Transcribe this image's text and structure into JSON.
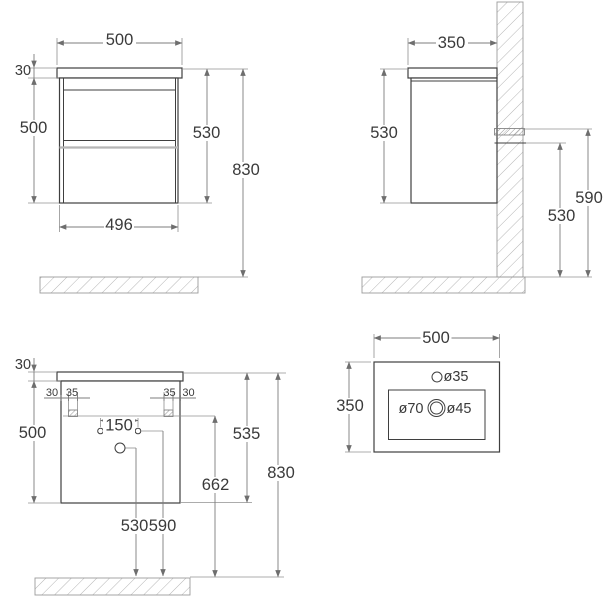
{
  "page": {
    "background": "#ffffff"
  },
  "colors": {
    "line": "#3f3f3f",
    "dimension": "#7d7d7d",
    "hatch": "#b5b5b5",
    "text": "#3a3a3a"
  },
  "views": {
    "front": {
      "width_top": "500",
      "top_thickness": "30",
      "body_height": "500",
      "cabinet_height": "530",
      "overall_height": "830",
      "width_bottom": "496"
    },
    "side": {
      "depth": "350",
      "cabinet_height": "530",
      "hanger_top_height": "590",
      "hanger_bottom_height": "530"
    },
    "back": {
      "top_thickness": "30",
      "body_height": "500",
      "hanger_offset_left": "30",
      "hanger_width_left": "35",
      "hanger_width_right": "35",
      "hanger_offset_right": "30",
      "supply_hole_spacing": "150",
      "drain_hole_height": "530",
      "supply_hole_height": "590",
      "front_edge_height": "535",
      "hanger_height": "662",
      "overall_height": "830"
    },
    "basin": {
      "width": "500",
      "depth": "350",
      "faucet_hole_diameter": "ø35",
      "drain_recess_diameter": "ø70",
      "drain_hole_diameter": "ø45"
    }
  }
}
